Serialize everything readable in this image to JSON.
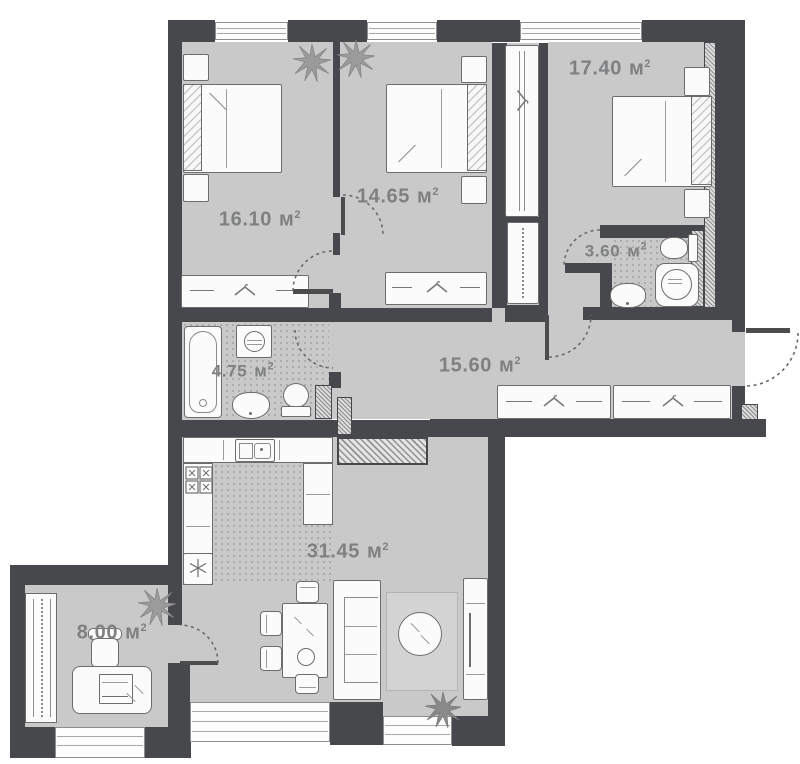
{
  "meta": {
    "unit": "м",
    "sup": "2"
  },
  "colors": {
    "wall": "#46484b",
    "floor": "#c9c9c9",
    "label_text": "#7e8082",
    "furniture_outline": "#6d6d6d"
  },
  "rooms": [
    {
      "name": "bedroom-1",
      "area": "16.10"
    },
    {
      "name": "bedroom-2",
      "area": "14.65"
    },
    {
      "name": "bedroom-3",
      "area": "17.40"
    },
    {
      "name": "bathroom-small",
      "area": "3.60"
    },
    {
      "name": "bathroom-main",
      "area": "4.75"
    },
    {
      "name": "hallway",
      "area": "15.60"
    },
    {
      "name": "living-kitchen",
      "area": "31.45"
    },
    {
      "name": "study",
      "area": "8.00"
    }
  ],
  "icons": {
    "plant": "plant-icon",
    "hanger": "hanger-icon",
    "snowflake": "snowflake-icon"
  }
}
